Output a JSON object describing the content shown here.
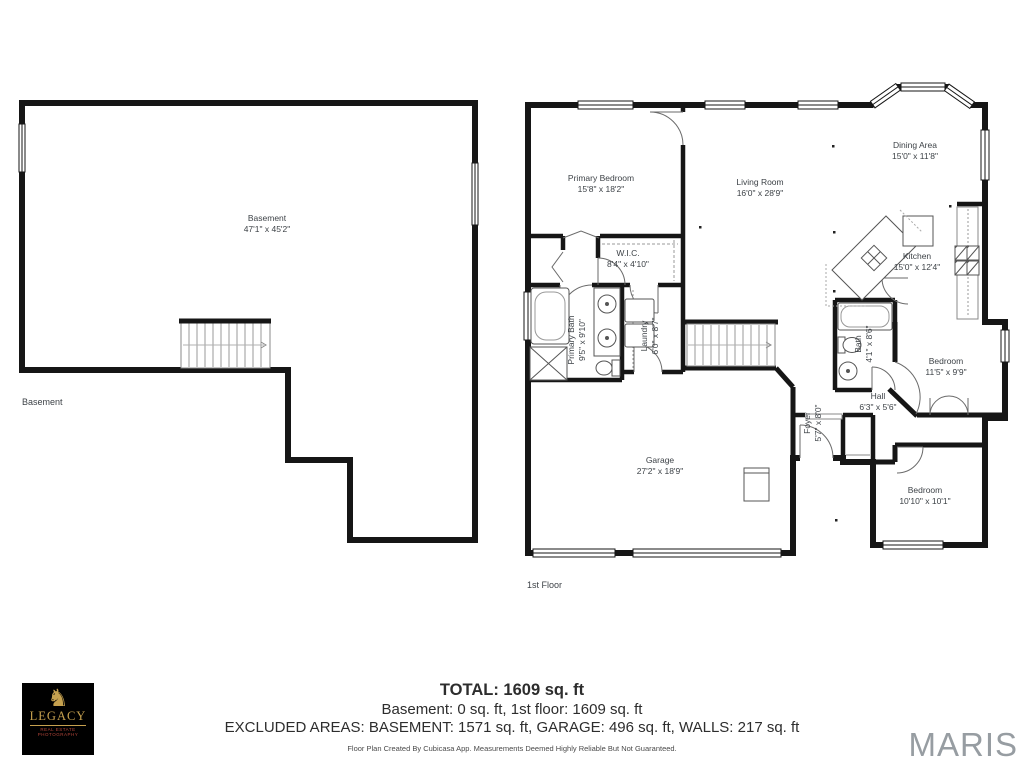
{
  "floors": {
    "basement": {
      "floor_label": "Basement",
      "rooms": [
        {
          "name": "Basement",
          "dims": "47'1\" x 45'2\""
        }
      ]
    },
    "first": {
      "floor_label": "1st Floor",
      "rooms": [
        {
          "name": "Primary Bedroom",
          "dims": "15'8\" x 18'2\""
        },
        {
          "name": "Living Room",
          "dims": "16'0\" x 28'9\""
        },
        {
          "name": "Dining Area",
          "dims": "15'0\" x 11'8\""
        },
        {
          "name": "Kitchen",
          "dims": "15'0\" x 12'4\""
        },
        {
          "name": "W.I.C.",
          "dims": "8'4\" x 4'10\""
        },
        {
          "name": "Primary Bath",
          "dims": "9'5\" x 9'10\""
        },
        {
          "name": "Laundry",
          "dims": "6'0\" x 8'7\""
        },
        {
          "name": "Garage",
          "dims": "27'2\" x 18'9\""
        },
        {
          "name": "Foyer",
          "dims": "5'7\" x 8'0\""
        },
        {
          "name": "Hall",
          "dims": "6'3\" x 5'6\""
        },
        {
          "name": "Bath",
          "dims": "4'1\" x 8'6\""
        },
        {
          "name": "Bedroom",
          "dims": "11'5\" x 9'9\""
        },
        {
          "name": "Bedroom",
          "dims": "10'10\" x 10'1\""
        }
      ]
    }
  },
  "summary": {
    "total": "TOTAL: 1609 sq. ft",
    "floors_line": "Basement: 0 sq. ft, 1st floor: 1609 sq. ft",
    "excluded_line": "EXCLUDED AREAS: BASEMENT: 1571 sq. ft, GARAGE: 496 sq. ft, WALLS: 217 sq. ft",
    "disclaimer": "Floor Plan Created By Cubicasa App. Measurements Deemed Highly Reliable But Not Guaranteed."
  },
  "branding": {
    "logo_name": "LEGACY",
    "logo_sub1": "REAL ESTATE",
    "logo_sub2": "PHOTOGRAPHY",
    "horse_glyph": "♞",
    "watermark": "MARIS"
  },
  "colors": {
    "wall": "#161616",
    "label_text": "#3d4247",
    "maris_gray": "#979da2",
    "logo_gold": "#c6a14f",
    "logo_red": "#b5463a",
    "logo_bg": "#000000"
  }
}
